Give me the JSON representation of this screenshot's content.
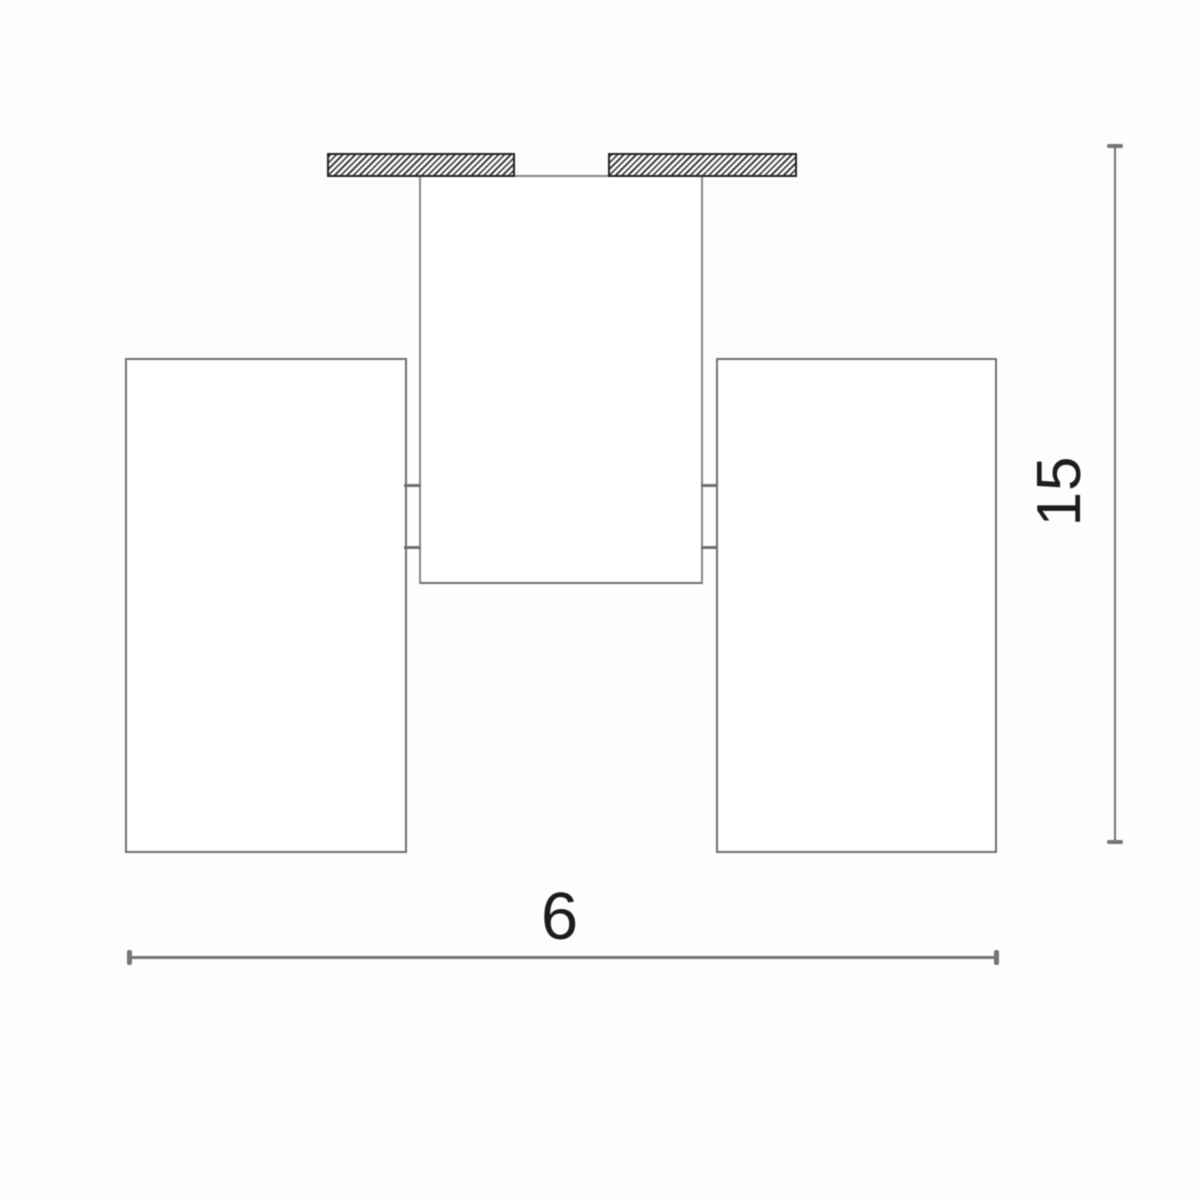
{
  "diagram": {
    "type": "technical-dimension-drawing",
    "subject": "ceiling-mounted twin-cylinder spotlight, front elevation",
    "dimensions": {
      "width": {
        "label": "6",
        "orientation": "horizontal"
      },
      "height": {
        "label": "15",
        "orientation": "vertical"
      }
    },
    "colors": {
      "background": "#fdfdfd",
      "outline": "#878787",
      "outline_dark": "#6f6f6f",
      "dimension_line": "#757575",
      "hatch_border": "#242424",
      "hatch_stroke": "#2b2b2b",
      "label_text": "#1c1c1c"
    }
  }
}
